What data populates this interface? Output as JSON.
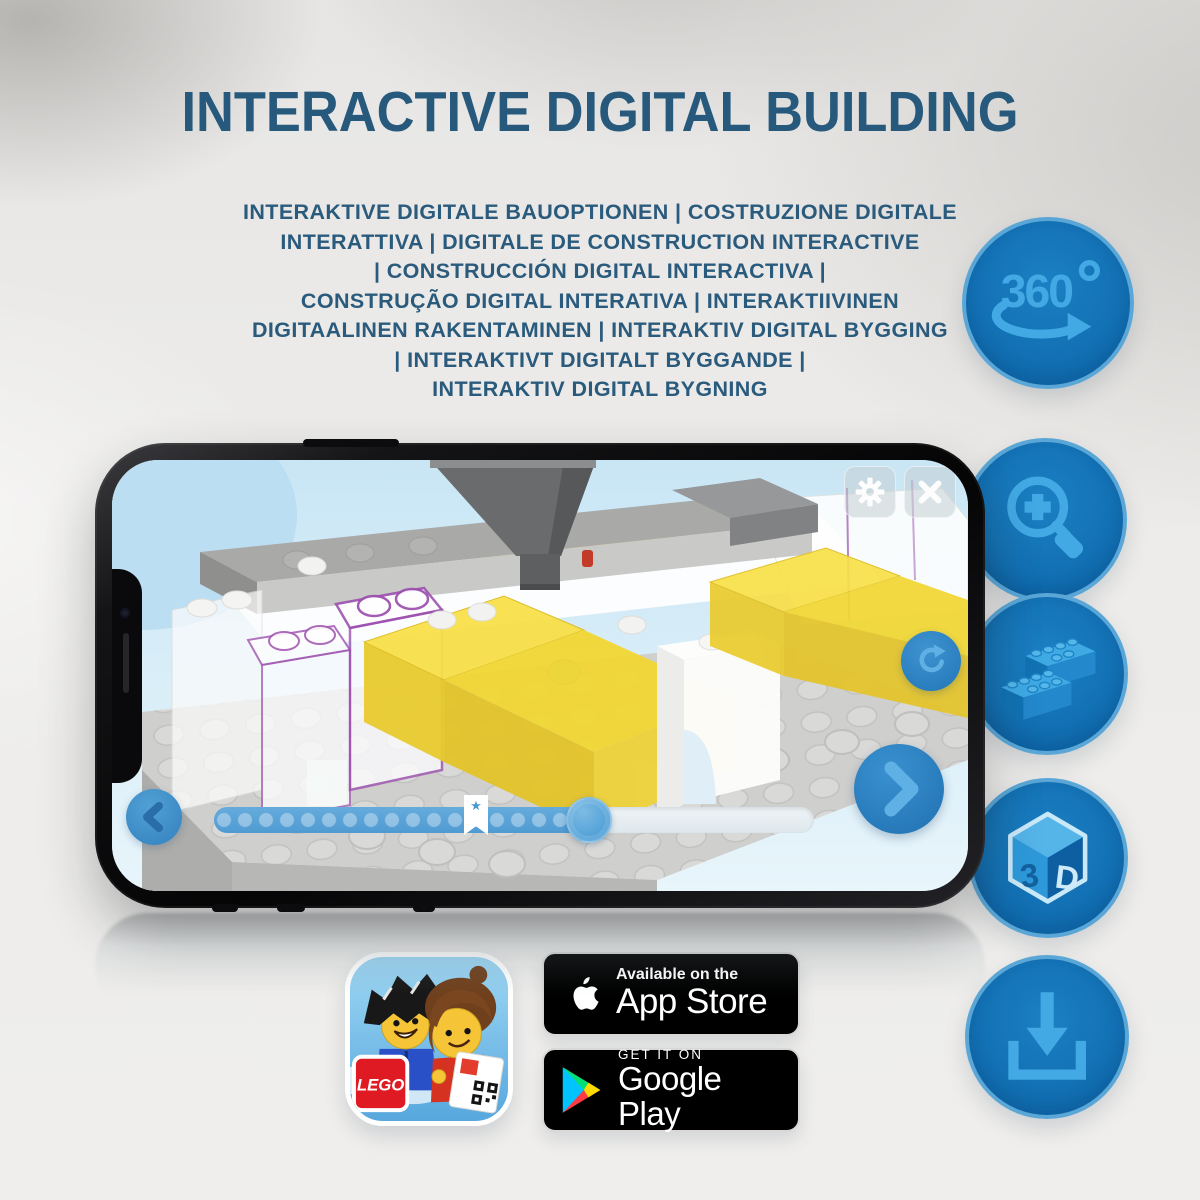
{
  "title": "INTERACTIVE DIGITAL BUILDING",
  "subtitle_lines": [
    "INTERAKTIVE DIGITALE BAUOPTIONEN | COSTRUZIONE DIGITALE",
    "INTERATTIVA | DIGITALE DE CONSTRUCTION INTERACTIVE",
    "| CONSTRUCCIÓN DIGITAL INTERACTIVA |",
    "CONSTRUÇÃO DIGITAL INTERATIVA | INTERAKTIIVINEN",
    "DIGITAALINEN RAKENTAMINEN | INTERAKTIV DIGITAL BYGGING",
    "| INTERAKTIVT DIGITALT BYGGANDE |",
    "INTERAKTIV DIGITAL BYGNING"
  ],
  "feature_icons": {
    "rotation_360": {
      "label": "360",
      "degree": "°"
    },
    "cube_3d": {
      "left": "3",
      "right": "D"
    }
  },
  "badges": {
    "app_store": {
      "line1": "Available on the",
      "line2": "App Store"
    },
    "google_play": {
      "line1": "GET IT ON",
      "line2": "Google Play"
    },
    "lego_app": {
      "logo_text": "LEGO"
    }
  },
  "colors": {
    "title_blue": "#26597c",
    "circle_blue": "#1173b7",
    "glyph_blue": "#42a9e4",
    "lego_yellow": "#f2d733",
    "lego_red": "#df1a22",
    "screen_blue": "#dff0f9"
  }
}
